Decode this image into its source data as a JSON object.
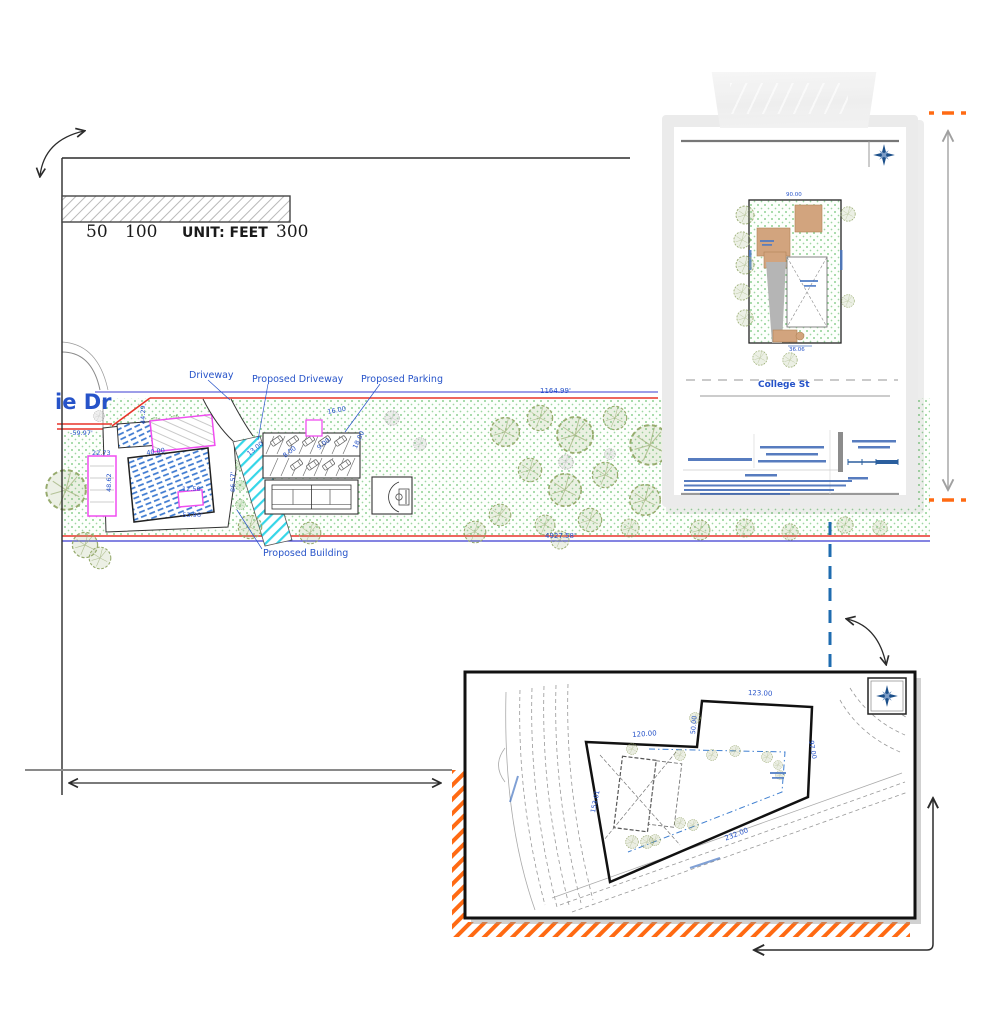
{
  "scale_bar": {
    "tick_50": "50",
    "tick_100": "100",
    "unit": "UNIT: FEET",
    "tick_300": "300"
  },
  "main_plan": {
    "street": "ie Dr",
    "driveway_label": "Driveway",
    "proposed_driveway_label": "Proposed Driveway",
    "proposed_parking_label": "Proposed Parking",
    "proposed_building_label": "Proposed Building",
    "dim_top": "1164.99'",
    "dim_bottom": "4927.58'",
    "dims": [
      {
        "t": "-59.97'"
      },
      {
        "t": "44.29"
      },
      {
        "t": "22.73"
      },
      {
        "t": "48.62"
      },
      {
        "t": "40.00"
      },
      {
        "t": "12.50"
      },
      {
        "t": "-53.96'"
      },
      {
        "t": "86.57'"
      },
      {
        "t": "13.00"
      },
      {
        "t": "8.00"
      },
      {
        "t": "9.00"
      },
      {
        "t": "16.00"
      },
      {
        "t": "18.00"
      }
    ]
  },
  "inset_top_right": {
    "street": "College St",
    "dim_top": "90.00",
    "dim_bottom": "36.06",
    "compass_n": "N"
  },
  "inset_bottom_right": {
    "dims": [
      {
        "t": "123.00"
      },
      {
        "t": "50.00"
      },
      {
        "t": "120.00"
      },
      {
        "t": "153.01"
      },
      {
        "t": "232.00"
      },
      {
        "t": "97.00"
      }
    ]
  },
  "colors": {
    "cad_blue": "#2653c9",
    "boundary_red": "#e8342a",
    "boundary_blue": "#3b3bd1",
    "cyan": "#35d6e8",
    "magenta": "#f04df0",
    "grass_green": "#3fae49",
    "orange": "#ff6a13",
    "tan": "#d2a47e",
    "compass_blue": "#1b4f8a"
  }
}
